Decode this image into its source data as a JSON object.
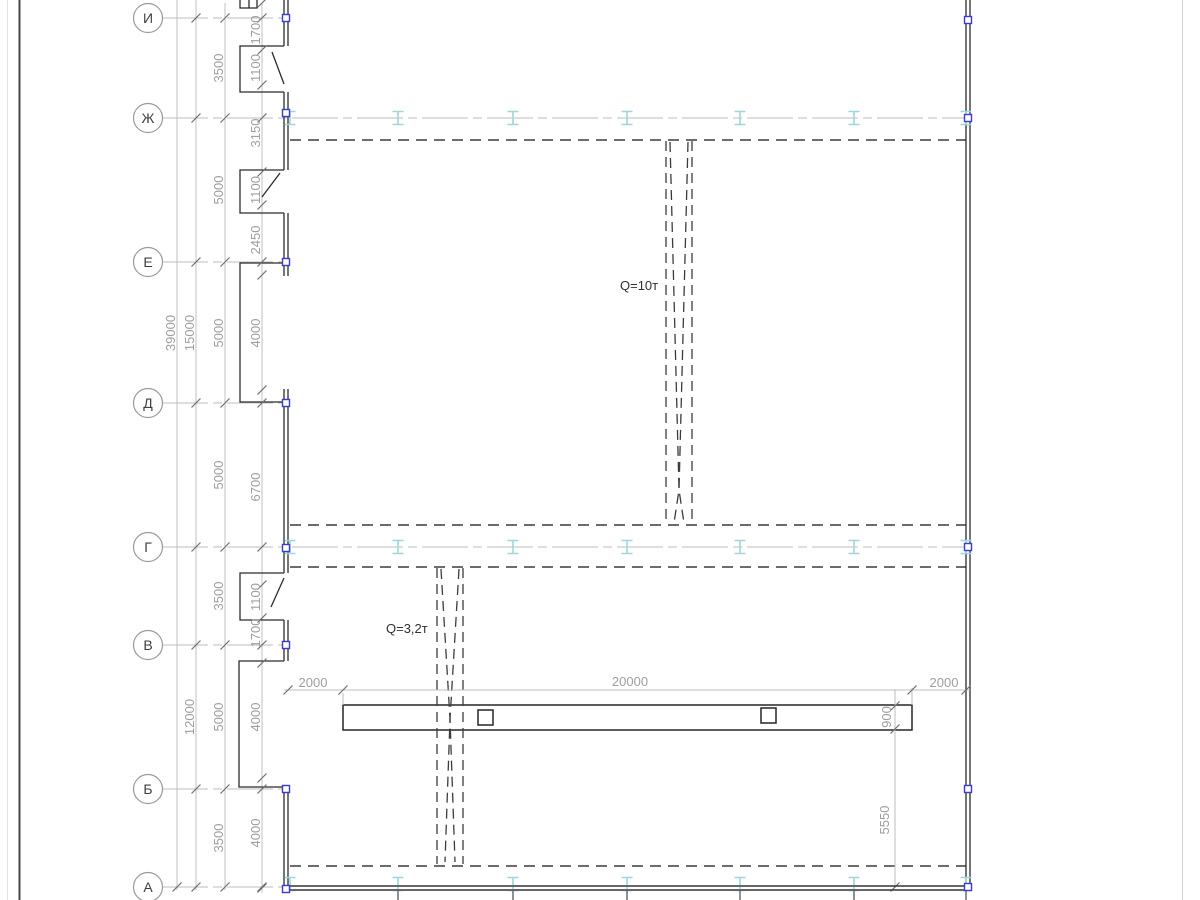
{
  "drawing": {
    "type": "structural-plan",
    "axes": {
      "bubbles": [
        {
          "label": "И"
        },
        {
          "label": "Ж"
        },
        {
          "label": "Е"
        },
        {
          "label": "Д"
        },
        {
          "label": "Г"
        },
        {
          "label": "В"
        },
        {
          "label": "Б"
        },
        {
          "label": "А"
        }
      ]
    },
    "dims": {
      "overall": "39000",
      "mid_top": "15000",
      "mid_bottom": "12000",
      "axis_chain": [
        "3500",
        "5000",
        "5000",
        "5000",
        "3500",
        "5000",
        "3500"
      ],
      "detail_chain": [
        "1700",
        "1100",
        "3150",
        "1100",
        "2450",
        "4000",
        "6700",
        "1100",
        "1700",
        "4000",
        "4000"
      ],
      "bottom_chain": [
        "2000",
        "20000",
        "2000"
      ],
      "beam_height": "900",
      "beam_offset": "5550"
    },
    "cranes": [
      {
        "label": "Q=10т"
      },
      {
        "label": "Q=3,2т"
      }
    ],
    "icons": {
      "rail_support": "i-beam-icon",
      "wall_node": "node-square-icon"
    },
    "colors": {
      "line_dark": "#2b2b2b",
      "line_dash": "#3c3c3c",
      "line_dim": "#bdbdbd",
      "text_dim": "#9e9e9e",
      "text_dark": "#303030",
      "axis_text": "#3f3f3f",
      "bubble_stroke": "#9a9a9a",
      "rail_cyan": "#9fd6da",
      "marker_blue": "#3b3bcf",
      "frame_dark": "#474747",
      "stub_gray": "#606060"
    }
  }
}
